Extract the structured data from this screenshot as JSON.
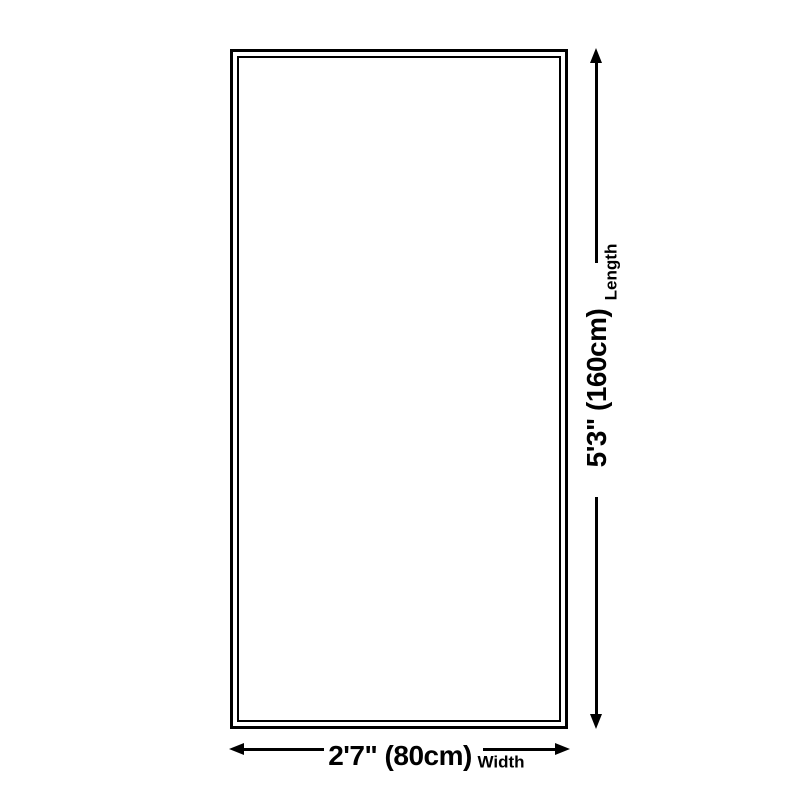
{
  "dimensions": {
    "length": {
      "value": "5'3\" (160cm)",
      "label": "Length"
    },
    "width": {
      "value": "2'7\" (80cm)",
      "label": "Width"
    }
  },
  "icons": {
    "arrow_up": "arrow-up-icon",
    "arrow_down": "arrow-down-icon",
    "arrow_left": "arrow-left-icon",
    "arrow_right": "arrow-right-icon"
  },
  "colors": {
    "line": "#000000",
    "text": "#000000",
    "background": "#ffffff",
    "product_fill": "#ffffff"
  }
}
